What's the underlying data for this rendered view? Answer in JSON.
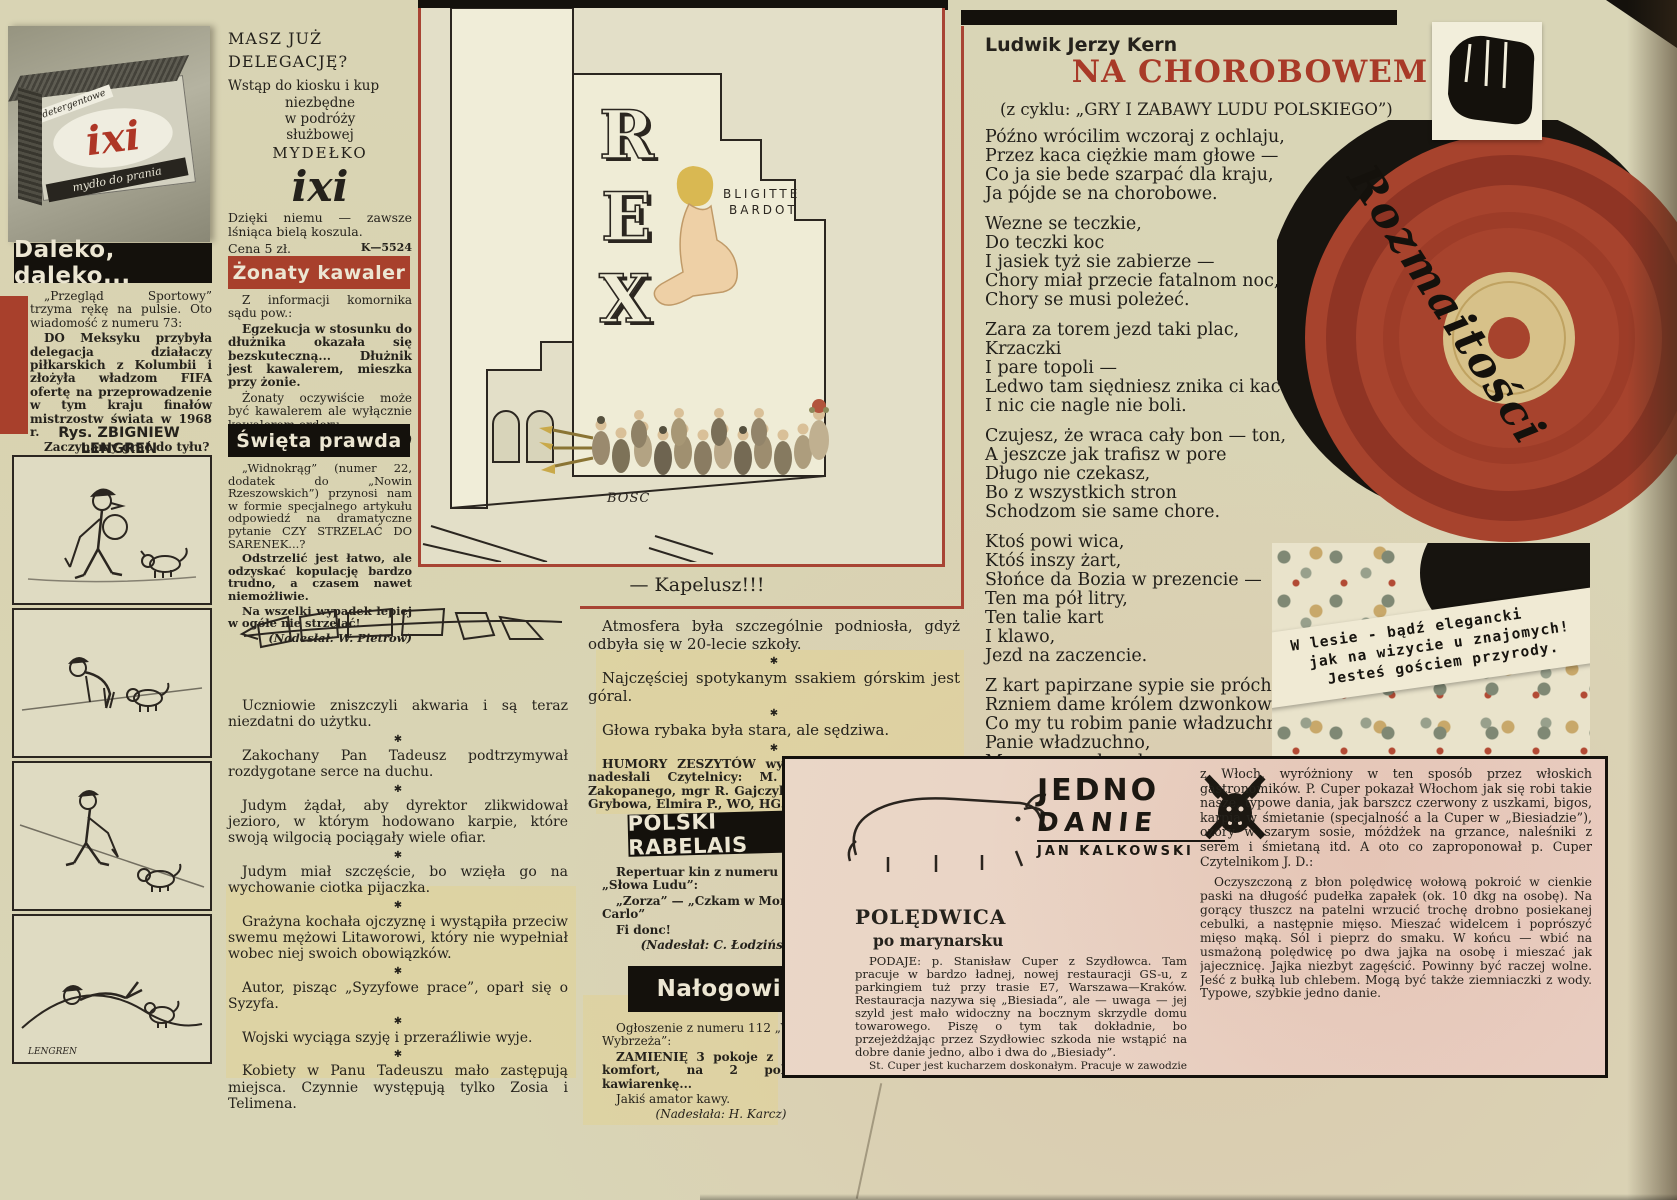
{
  "glyphs": {
    "star": "✱"
  },
  "colors": {
    "accent_red": "#a8402c",
    "record_red": "#a7432d",
    "ink": "#25221c"
  },
  "ixi_photo": {
    "label_top": "detergentowe",
    "brand": "ixi",
    "label_bottom": "mydło do prania"
  },
  "daleko": {
    "header": "Daleko, daleko...",
    "p1": "„Przegląd Sportowy” trzyma rękę na pulsie. Oto wiadomość z numeru 73:",
    "p2": "DO Meksyku przybyła delegacja działaczy piłkarskich z Kolumbii i złożyła władzom FIFA ofertę na przeprowadzenie w tym kraju finałów mistrzostw świata w 1968 r.",
    "p3": "Zaczynamy grać do tyłu?",
    "byline": "(Nadesłał: J. Tuna)"
  },
  "lengren": {
    "heading": "Rys. ZBIGNIEW LENGREN",
    "signature": "LENGREN"
  },
  "ixi_ad": {
    "l1": "MASZ JUŻ",
    "l2": "DELEGACJĘ?",
    "l3": "Wstąp do kiosku i kup",
    "l4": "niezbędne",
    "l5": "w podróży",
    "l6": "służbowej",
    "l7": "MYDEŁKO",
    "brand": "ixi",
    "l8": "Dzięki niemu — zawsze lśniąca bielą koszula.",
    "price": "Cena 5 zł.",
    "code": "K—5524"
  },
  "zonaty": {
    "header": "Żonaty kawaler",
    "p1": "Z informacji komornika sądu pow.:",
    "p2": "Egzekucja w stosunku do dłużnika okazała się bezskuteczną... Dłużnik jest kawalerem, mieszka przy żonie.",
    "p3": "Żonaty oczywiście może być kawalerem ale wyłącznie kawalerem orderu.",
    "byline": "(Nad.: W. Kołodziejczyk)"
  },
  "swieta": {
    "header": "Święta prawda",
    "p1": "„Widnokrąg” (numer 22, dodatek do „Nowin Rzeszowskich”) przynosi nam w formie specjalnego artykułu odpowiedź na dramatyczne pytanie CZY STRZELAĆ DO SARENEK...?",
    "p2": "Odstrzelić jest łatwo, ale odzyskać kopulację bardzo trudno, a czasem nawet niemożliwie.",
    "p3": "Na wszelki wypadek lepiej w ogóle nie strzelać!",
    "byline": "(Nadesłał: W. Pietrow)"
  },
  "cartoon": {
    "sign_r": "R",
    "sign_e": "E",
    "sign_x": "X",
    "poster_l1": "BLIGITTE",
    "poster_l2": "BARDOT",
    "signature": "BOSC",
    "caption": "— Kapelusz!!!"
  },
  "humor_left": {
    "items": [
      "Uczniowie zniszczyli akwaria i są teraz niezdatni do użytku.",
      "Zakochany Pan Tadeusz podtrzymywał rozdygotane serce na duchu.",
      "Judym żądał, aby dyrektor zlikwidował jezioro, w którym hodowano karpie, które swoją wilgocią pociągały wiele ofiar.",
      "Judym miał szczęście, bo wzięła go na wychowanie ciotka pijaczka.",
      "Grażyna kochała ojczyznę i wystąpiła przeciw swemu mężowi Litaworowi, który nie wypełniał wobec niej swoich obowiązków.",
      "Autor, pisząc „Syzyfowe prace”, oparł się o Syzyfa.",
      "Wojski wyciąga szyję i przeraźliwie wyje.",
      "Kobiety w Panu Tadeuszu mało zastępują miejsca. Czynnie występują tylko Zosia i Telimena."
    ]
  },
  "humor_center": {
    "items": [
      "Atmosfera była szczególnie podniosła, gdyż odbyła się w 20-lecie szkoły.",
      "Najczęściej spotykanym ssakiem górskim jest góral.",
      "Głowa rybaka była stara, ale sędziwa."
    ],
    "credit": "HUMORY ZESZYTÓW wybraliśmy z listów, które nadesłali Czytelnicy: M. Dziewit, J. Noder z Zakopanego, mgr R. Gajczyk, mgr MS, EC, Maria F. z Grybowa, Elmira P., WO, HG.",
    "thanks": "Dziękujemy."
  },
  "rabelais": {
    "header": "POLSKI RABELAIS",
    "p1": "Repertuar kin z numeru 168 „Słowa Ludu”:",
    "p2": "„Zorza” — „Czkam w Monte Carlo”",
    "p3": "Fi donc!",
    "byline": "(Nadesłał: C. Łodziński)"
  },
  "nalogowiec": {
    "header": "Nałogowiec",
    "p1": "Ogłoszenie z numeru 112 „Wieczoru Wybrzeża”:",
    "p2": "ZAMIENIĘ 3 pokoje z kuchnią, komfort, na 2 pokoje i kawiarenkę...",
    "p3": "Jakiś amator kawy.",
    "byline": "(Nadesłała: H. Karcz)"
  },
  "poem": {
    "author": "Ludwik Jerzy Kern",
    "title": "NA CHOROBOWEM",
    "subtitle": "(z cyklu: „GRY I ZABAWY LUDU POLSKIEGO”)",
    "stanzas": [
      "Późno wrócilim wczoraj z ochlaju,\nPrzez kaca ciężkie mam głowe —\nCo ja sie bede szarpać dla kraju,\nJa pójde se na chorobowe.",
      "Wezne se teczkie,\nDo teczki koc\nI jasiek tyż sie zabierze —\nChory miał przecie fatalnom noc,\nChory se musi poleżeć.",
      "Zara za torem jezd taki plac,\nKrzaczki\nI pare topoli —\nLedwo tam siędniesz znika ci kac\nI nic cie nagle nie boli.",
      "Czujesz, że wraca cały bon — ton,\nA jeszcze jak trafisz w pore\nDługo nie czekasz,\nBo z wszystkich stron\nSchodzom sie same chore.",
      "Ktoś powi wica,\nKtóś inszy żart,\nSłońce da Bozia w prezencie —\nTen ma pół litry,\nTen talie kart\nI klawo,\nJezd na zaczencie.",
      "Z kart papirzane sypie sie próchno,\nRzniem dame królem dzwonkowem —\nCo my tu robim panie władzuchno?\nPanie władzuchno,\nMy som na chorobowem."
    ]
  },
  "rozmaitosci": {
    "script": "Rozmaitości"
  },
  "forest": {
    "l1": "W lesie - bądź elegancki",
    "l2": "jak na wizycie u znajomych!",
    "l3": "Jesteś gościem przyrody."
  },
  "recipe": {
    "logo_l1": "JEDNO",
    "logo_l2": "DANIE",
    "logo_l3": "JAN KALKOWSKI",
    "title": "POLĘDWICA",
    "subtitle": "po marynarsku",
    "c1p1": "PODAJE: p. Stanisław Cuper z Szydłowca. Tam pracuje w bardzo ładnej, nowej restauracji GS-u, z parkingiem tuż przy trasie E7, Warszawa—Kraków. Restauracja nazywa się „Biesiada”, ale — uwaga — jej szyld jest mało widoczny na bocznym skrzydle domu towarowego. Piszę o tym tak dokładnie, bo przejeżdżając przez Szydłowiec szkoda nie wstąpić na dobre danie jedno, albo i dwa do „Biesiady”.",
    "c1p2": "St. Cuper jest kucharzem doskonałym. Pracuje w zawodzie 44 lata i pisaliśmy już o nim kiedyś w P. 1307 z okazji pięknego pucharu jaki przywiózł",
    "c2p1": "z Włoch, wyróżniony w ten sposób przez włoskich gastronomików. P. Cuper pokazał Włochom jak się robi takie nasze, typowe dania, jak barszcz czerwony z uszkami, bigos, karpia w śmietanie (specjalność a la Cuper w „Biesiadzie”), ozory w szarym sosie, móżdżek na grzance, naleśniki z serem i śmietaną itd. A oto co zaproponował p. Cuper Czytelnikom J. D.:",
    "c2p2": "Oczyszczoną z błon polędwicę wołową pokroić w cienkie paski na długość pudełka zapałek (ok. 10 dkg na osobę). Na gorący tłuszcz na patelni wrzucić trochę drobno posiekanej cebulki, a następnie mięso. Mieszać widelcem i poprószyć mięso mąką. Sól i pieprz do smaku. W końcu — wbić na usmażoną polędwicę po dwa jajka na osobę i mieszać jak jajecznicę. Jajka niezbyt zagęścić. Powinny być raczej wolne. Jeść z bułką lub chlebem. Mogą być także ziemniaczki z wody. Typowe, szybkie jedno danie."
  }
}
